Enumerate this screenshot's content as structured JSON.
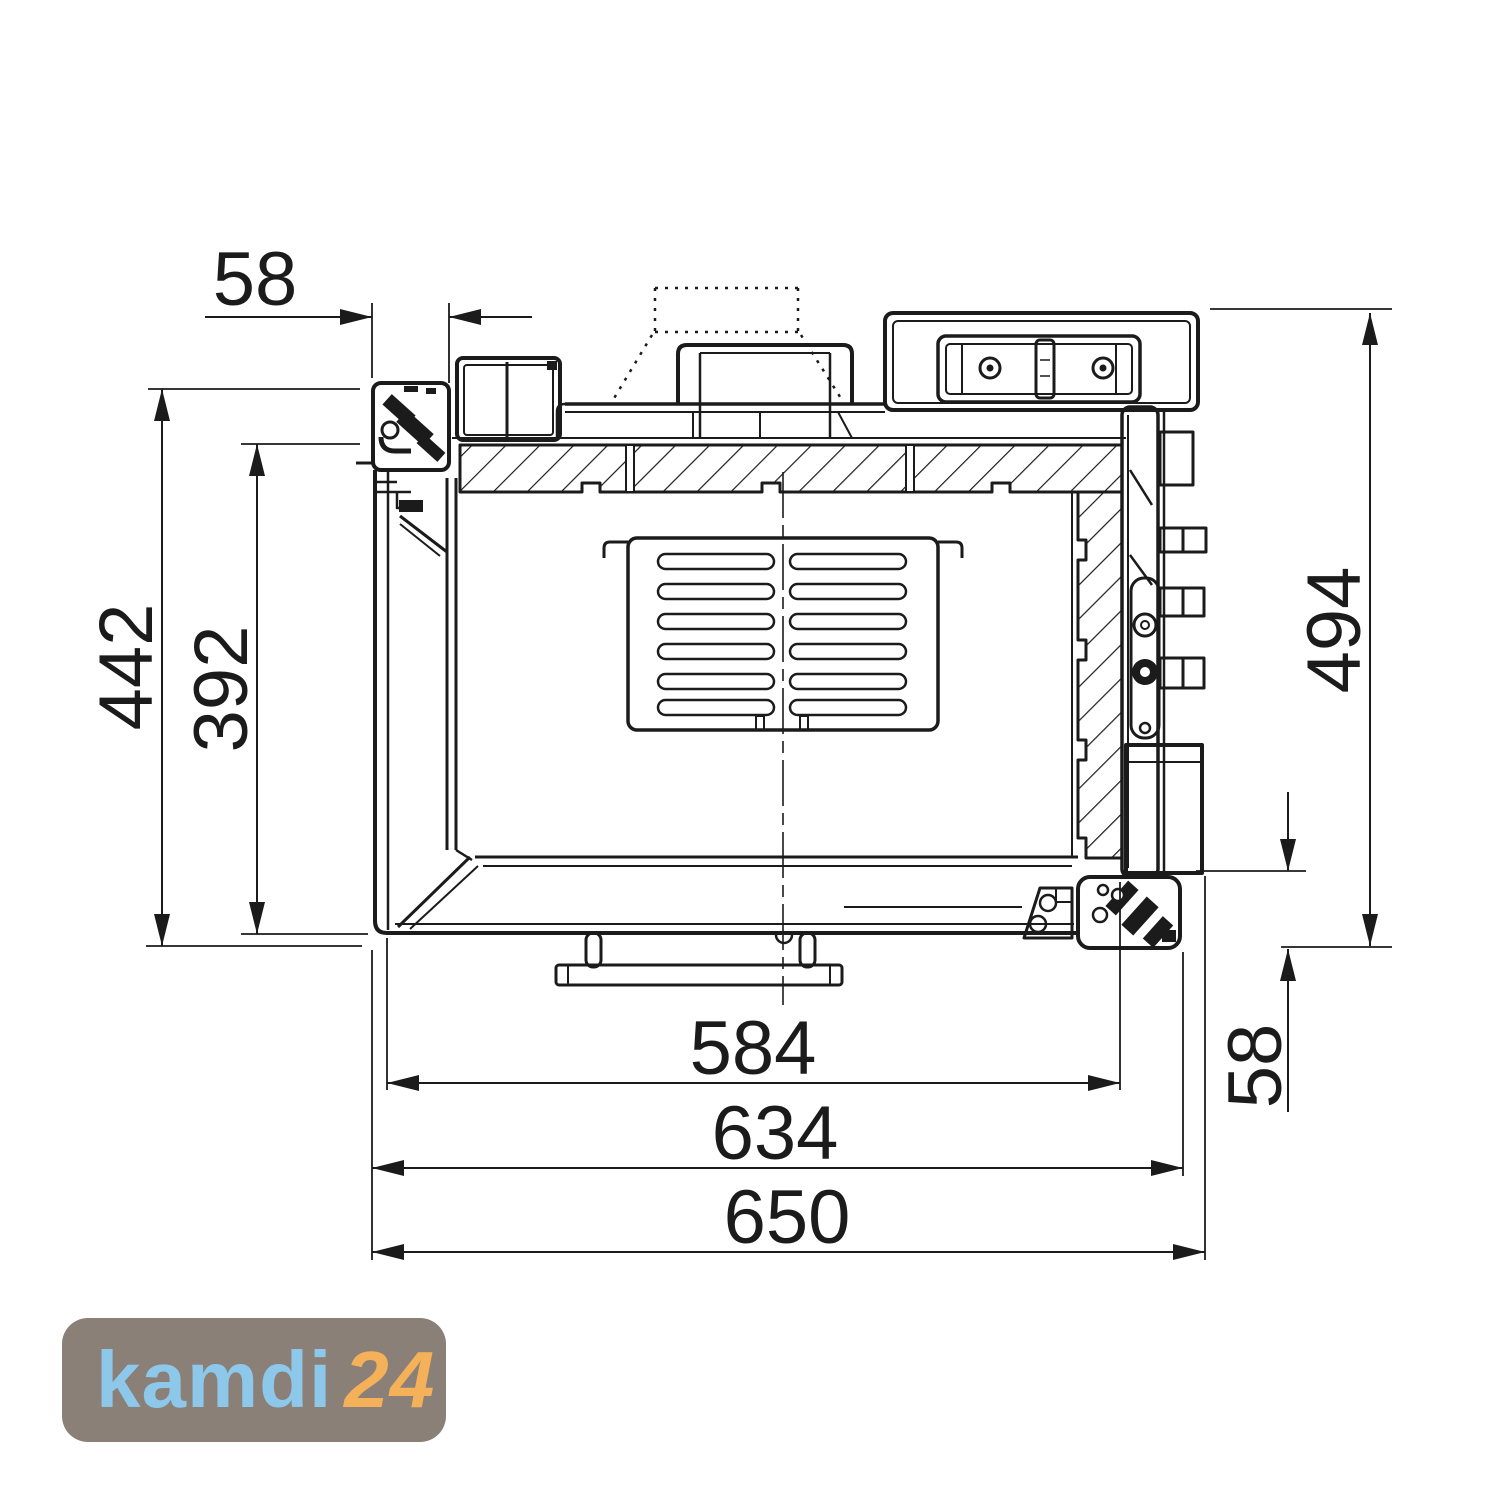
{
  "drawing": {
    "type": "technical-cross-section",
    "dimensions": {
      "top_offset": "58",
      "height_outer": "442",
      "height_inner": "392",
      "height_right": "494",
      "bottom_right_offset": "58",
      "width_inner": "584",
      "width_mid": "634",
      "width_overall": "650"
    }
  },
  "logo": {
    "brand": "kamdi",
    "suffix": "24",
    "bg_color": "#8a8078",
    "brand_color": "#8dc8eb",
    "suffix_color": "#f4b159"
  },
  "colors": {
    "line": "#1b1b1b",
    "background": "#ffffff"
  }
}
